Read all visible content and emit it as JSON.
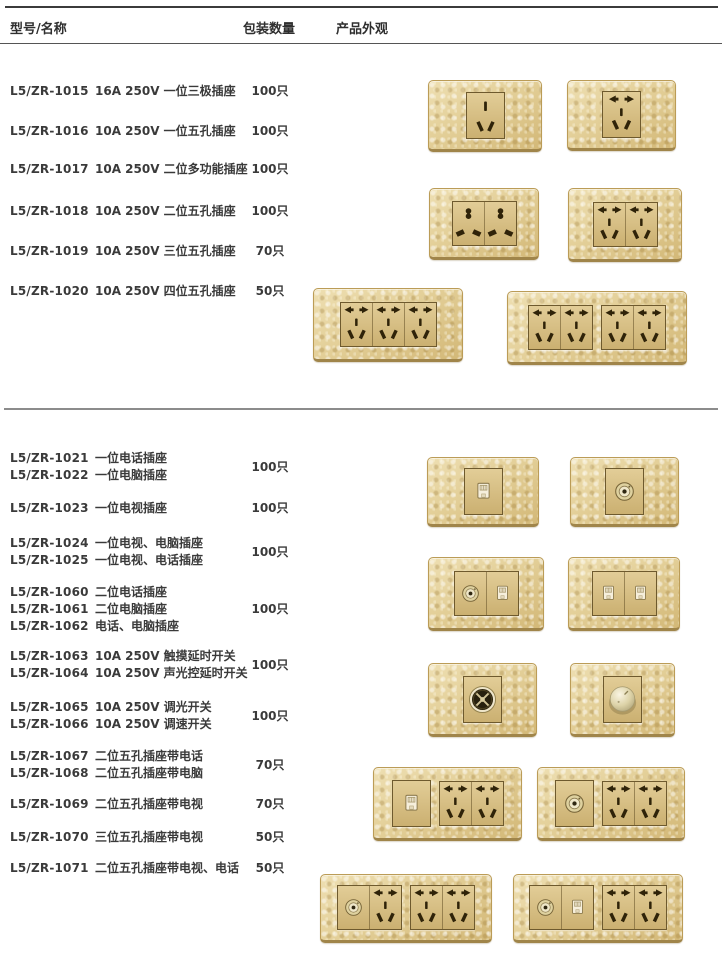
{
  "header": {
    "col_model_name": "型号/名称",
    "col_qty": "包装数量",
    "col_appearance": "产品外观"
  },
  "colors": {
    "plate_gold": "#e3cf98",
    "plate_border": "#b3954f",
    "module_face": "#d8c083",
    "hole_brown": "#2f2309",
    "text": "#3a3a3a",
    "rule_dark": "#3b3b3b",
    "rule_gray": "#8c8c8c"
  },
  "icon_names": {
    "pin3": "socket-3pin-icon",
    "pin5": "socket-5hole-icon",
    "multi": "socket-universal-icon",
    "rj": "rj-jack-icon",
    "tv": "tv-coax-icon",
    "touch": "touch-switch-icon",
    "knob": "dimmer-knob-icon"
  },
  "sections": [
    {
      "groups": [
        {
          "models": [
            {
              "code": "L5/ZR-1015",
              "name": "16A 250V 一位三极插座"
            }
          ],
          "qty": "100只"
        },
        {
          "models": [
            {
              "code": "L5/ZR-1016",
              "name": "10A 250V 一位五孔插座"
            }
          ],
          "qty": "100只"
        },
        {
          "models": [
            {
              "code": "L5/ZR-1017",
              "name": "10A 250V 二位多功能插座"
            }
          ],
          "qty": "100只"
        },
        {
          "models": [
            {
              "code": "L5/ZR-1018",
              "name": "10A 250V 二位五孔插座"
            }
          ],
          "qty": "100只"
        },
        {
          "models": [
            {
              "code": "L5/ZR-1019",
              "name": "10A 250V 三位五孔插座"
            }
          ],
          "qty": "70只"
        },
        {
          "models": [
            {
              "code": "L5/ZR-1020",
              "name": "10A 250V 四位五孔插座"
            }
          ],
          "qty": "50只"
        }
      ]
    },
    {
      "groups": [
        {
          "models": [
            {
              "code": "L5/ZR-1021",
              "name": "一位电话插座"
            },
            {
              "code": "L5/ZR-1022",
              "name": "一位电脑插座"
            }
          ],
          "qty": "100只"
        },
        {
          "models": [
            {
              "code": "L5/ZR-1023",
              "name": "一位电视插座"
            }
          ],
          "qty": "100只"
        },
        {
          "models": [
            {
              "code": "L5/ZR-1024",
              "name": "一位电视、电脑插座"
            },
            {
              "code": "L5/ZR-1025",
              "name": "一位电视、电话插座"
            }
          ],
          "qty": "100只"
        },
        {
          "models": [
            {
              "code": "L5/ZR-1060",
              "name": "二位电话插座"
            },
            {
              "code": "L5/ZR-1061",
              "name": "二位电脑插座"
            },
            {
              "code": "L5/ZR-1062",
              "name": "电话、电脑插座"
            }
          ],
          "qty": "100只"
        },
        {
          "models": [
            {
              "code": "L5/ZR-1063",
              "name": "10A 250V 触摸延时开关"
            },
            {
              "code": "L5/ZR-1064",
              "name": "10A 250V 声光控延时开关"
            }
          ],
          "qty": "100只"
        },
        {
          "models": [
            {
              "code": "L5/ZR-1065",
              "name": "10A 250V 调光开关"
            },
            {
              "code": "L5/ZR-1066",
              "name": "10A 250V 调速开关"
            }
          ],
          "qty": "100只"
        },
        {
          "models": [
            {
              "code": "L5/ZR-1067",
              "name": "二位五孔插座带电话"
            },
            {
              "code": "L5/ZR-1068",
              "name": "二位五孔插座带电脑"
            }
          ],
          "qty": "70只"
        },
        {
          "models": [
            {
              "code": "L5/ZR-1069",
              "name": "二位五孔插座带电视"
            }
          ],
          "qty": "70只"
        },
        {
          "models": [
            {
              "code": "L5/ZR-1070",
              "name": "三位五孔插座带电视"
            }
          ],
          "qty": "50只"
        },
        {
          "models": [
            {
              "code": "L5/ZR-1071",
              "name": "二位五孔插座带电视、电话"
            }
          ],
          "qty": "50只"
        }
      ]
    }
  ],
  "plates": [
    {
      "name": "plate-1gang-3pin-socket",
      "x": 428,
      "y": 80,
      "w": 112,
      "h": 68,
      "units": [
        [
          "pin3"
        ]
      ]
    },
    {
      "name": "plate-1gang-5hole-socket",
      "x": 567,
      "y": 80,
      "w": 107,
      "h": 67,
      "units": [
        [
          "pin5"
        ]
      ]
    },
    {
      "name": "plate-2gang-universal-socket",
      "x": 429,
      "y": 188,
      "w": 108,
      "h": 68,
      "units": [
        [
          "multi",
          "multi"
        ]
      ]
    },
    {
      "name": "plate-2gang-5hole-socket",
      "x": 568,
      "y": 188,
      "w": 112,
      "h": 70,
      "units": [
        [
          "pin5",
          "pin5"
        ]
      ]
    },
    {
      "name": "plate-3gang-5hole-socket",
      "x": 313,
      "y": 288,
      "w": 148,
      "h": 70,
      "units": [
        [
          "pin5",
          "pin5",
          "pin5"
        ]
      ]
    },
    {
      "name": "plate-4gang-5hole-socket",
      "x": 507,
      "y": 291,
      "w": 178,
      "h": 70,
      "units": [
        [
          "pin5",
          "pin5"
        ],
        [
          "pin5",
          "pin5"
        ]
      ]
    },
    {
      "name": "plate-phone-socket",
      "x": 427,
      "y": 457,
      "w": 110,
      "h": 66,
      "units": [
        [
          "rj"
        ]
      ]
    },
    {
      "name": "plate-tv-socket",
      "x": 570,
      "y": 457,
      "w": 107,
      "h": 66,
      "units": [
        [
          "tv"
        ]
      ]
    },
    {
      "name": "plate-tv-computer-socket",
      "x": 428,
      "y": 557,
      "w": 114,
      "h": 70,
      "units": [
        [
          "tv",
          "rj"
        ]
      ]
    },
    {
      "name": "plate-2gang-phone-socket",
      "x": 568,
      "y": 557,
      "w": 110,
      "h": 70,
      "units": [
        [
          "rj",
          "rj"
        ]
      ]
    },
    {
      "name": "plate-touch-delay-switch",
      "x": 428,
      "y": 663,
      "w": 107,
      "h": 70,
      "units": [
        [
          "touch"
        ]
      ]
    },
    {
      "name": "plate-dimmer-switch",
      "x": 570,
      "y": 663,
      "w": 103,
      "h": 70,
      "units": [
        [
          "knob"
        ]
      ]
    },
    {
      "name": "plate-phone-plus-2x5hole",
      "x": 373,
      "y": 767,
      "w": 147,
      "h": 70,
      "units": [
        [
          "rj"
        ],
        [
          "pin5",
          "pin5"
        ]
      ]
    },
    {
      "name": "plate-tv-plus-2x5hole",
      "x": 537,
      "y": 767,
      "w": 146,
      "h": 70,
      "units": [
        [
          "tv"
        ],
        [
          "pin5",
          "pin5"
        ]
      ]
    },
    {
      "name": "plate-tv-plus-3x5hole",
      "x": 320,
      "y": 874,
      "w": 170,
      "h": 65,
      "units": [
        [
          "tv",
          "pin5"
        ],
        [
          "pin5",
          "pin5"
        ]
      ]
    },
    {
      "name": "plate-tv-phone-plus-2x5hole",
      "x": 513,
      "y": 874,
      "w": 168,
      "h": 65,
      "units": [
        [
          "tv",
          "rj"
        ],
        [
          "pin5",
          "pin5"
        ]
      ]
    }
  ]
}
